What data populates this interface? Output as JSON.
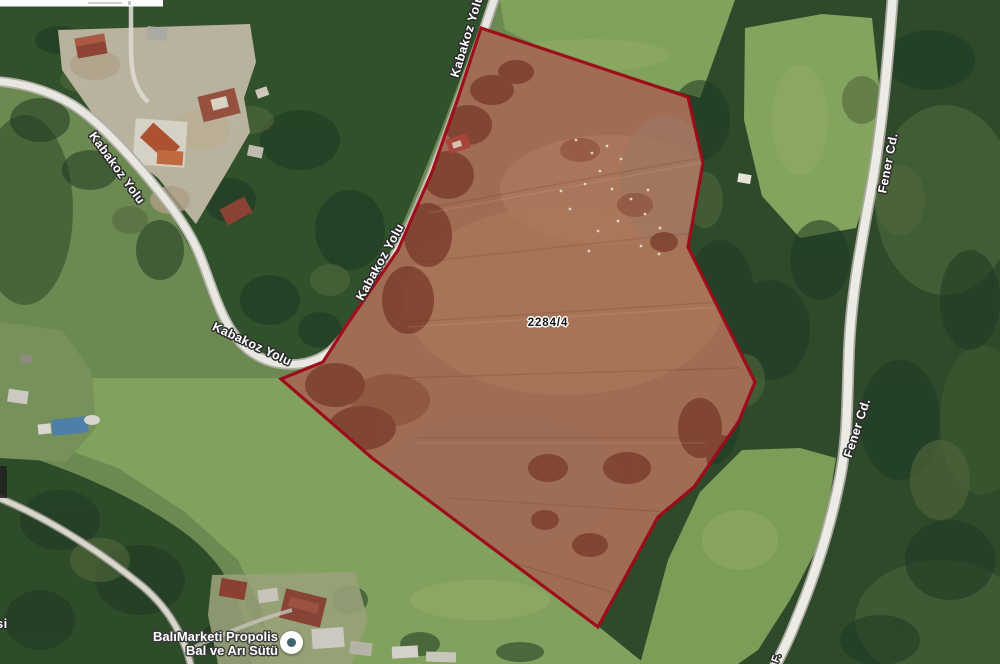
{
  "map": {
    "parcel": {
      "number": "2284/4",
      "border_color": "#9d0a18",
      "fill_color": "#a06c54"
    },
    "road_labels": [
      {
        "text": "Kabakoz Yolu"
      },
      {
        "text": "Kabakoz Yolu"
      },
      {
        "text": "Kabakoz Yolu"
      },
      {
        "text": "Kabakoz Yolu"
      },
      {
        "text": "Fener Cd."
      },
      {
        "text": "Fener Cd."
      }
    ],
    "poi": {
      "line1": "BalıMarketi Propolis",
      "line2": "Bal ve Arı Sütü",
      "marker_dot_color": "#3f6470"
    },
    "partial_labels": {
      "left_edge": "si",
      "bottom_edge": "F."
    }
  }
}
